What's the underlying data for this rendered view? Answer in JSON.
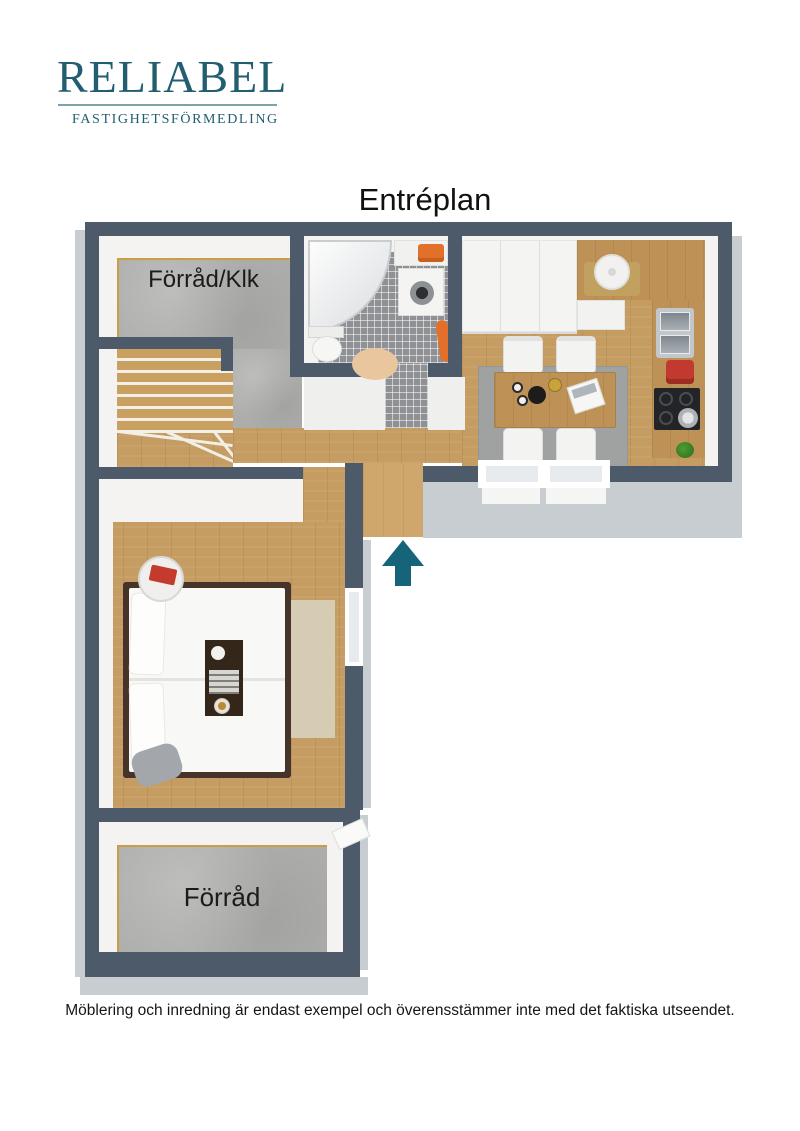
{
  "header": {
    "logo": {
      "name": "RELIABEL",
      "tagline": "FASTIGHETSFÖRMEDLING"
    }
  },
  "floorplan": {
    "title": "Entréplan",
    "rooms": {
      "forrad_klk": {
        "label": "Förråd/Klk"
      },
      "forrad": {
        "label": "Förråd"
      }
    },
    "icons": {
      "entrance_arrow": "arrow-up"
    }
  },
  "footer": {
    "disclaimer": "Möblering och inredning är endast exempel och överensstämmer inte med det faktiska utseendet."
  },
  "colors": {
    "logo_teal": "#215E70",
    "wall": "#4C5A6A",
    "wall_face": "#C8CDD2",
    "wood_floor": "#C59D62",
    "concrete_floor": "#ADADAB",
    "tile_floor": "#8F9194",
    "arrow_teal": "#16647A",
    "accent_orange": "#E2702A",
    "accent_red": "#C23A2F",
    "rug_beige": "#D6CCB3",
    "rug_gray": "#A0A2A2"
  }
}
